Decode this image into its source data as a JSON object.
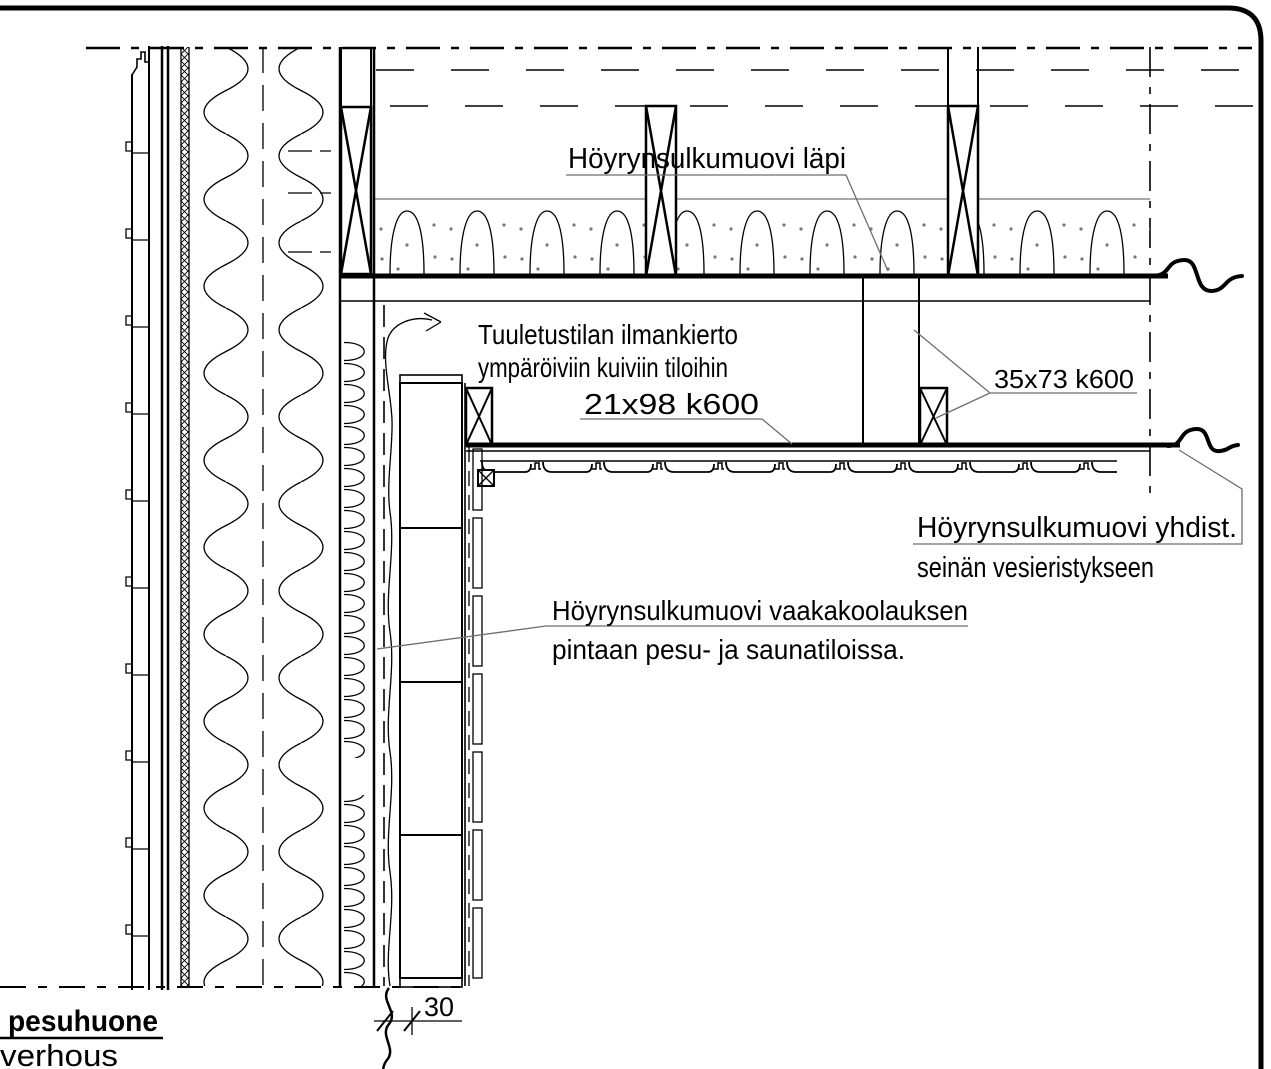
{
  "drawing": {
    "title_labels": {
      "vapor_through": "Höyrynsulkumuovi läpi",
      "ventilation_line1": "Tuuletustilan ilmankierto",
      "ventilation_line2": "ympäröiviin kuiviin tiloihin",
      "batten_21x98": "21x98 k600",
      "batten_35x73": "35x73 k600",
      "vapor_join_line1": "Höyrynsulkumuovi yhdist.",
      "vapor_join_line2": "seinän vesieristykseen",
      "vapor_wall_line1": "Höyrynsulkumuovi vaakakoolauksen",
      "vapor_wall_line2": "pintaan pesu- ja saunatiloissa.",
      "room_name": "pesuhuone",
      "cladding_word": "verhous",
      "dimension_30": "30"
    },
    "colors": {
      "line": "#000000",
      "background": "#ffffff",
      "leader": "#3c3c3c",
      "insulation_top_line": "#8a8a8a"
    }
  }
}
